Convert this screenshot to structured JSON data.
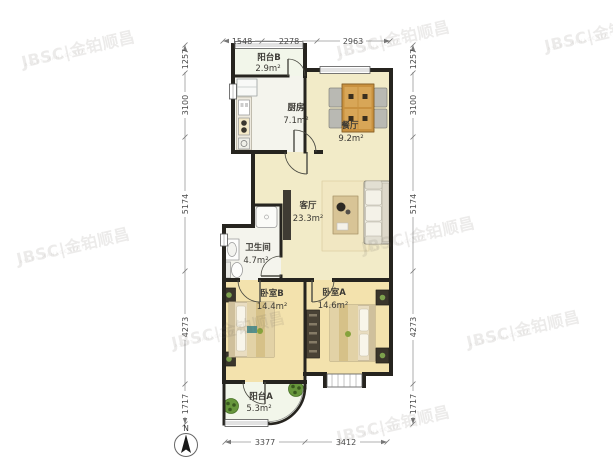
{
  "watermark": {
    "text": "JBSC|金铂顺昌",
    "subtext": "ASSET MANAGEMENT"
  },
  "compass": {
    "north_label": "N"
  },
  "rooms": {
    "balcony_b": {
      "name": "阳台B",
      "area": "2.9m²"
    },
    "kitchen": {
      "name": "厨房",
      "area": "7.1m²"
    },
    "dining": {
      "name": "餐厅",
      "area": "9.2m²"
    },
    "living": {
      "name": "客厅",
      "area": "23.3m²"
    },
    "bathroom": {
      "name": "卫生间",
      "area": "4.7m²"
    },
    "bedroom_b": {
      "name": "卧室B",
      "area": "14.4m²"
    },
    "bedroom_a": {
      "name": "卧室A",
      "area": "14.6m²"
    },
    "balcony_a": {
      "name": "阳台A",
      "area": "5.3m²"
    }
  },
  "dimensions_mm": {
    "top": [
      "1548",
      "2278",
      "2963"
    ],
    "bottom": [
      "3377",
      "3412"
    ],
    "left": [
      "1257",
      "3100",
      "5174",
      "4273",
      "1717"
    ],
    "right": [
      "1257",
      "3100",
      "5174",
      "4273",
      "1717"
    ]
  },
  "colors": {
    "wall": "#26241f",
    "living_floor": "#f2ebc8",
    "bedroom_floor": "#f3e2ad",
    "wet_floor": "#f4f4ed",
    "balcony_floor": "#f2f6ea",
    "wood": "#c9913f",
    "accent_green": "#6a9a3f"
  }
}
